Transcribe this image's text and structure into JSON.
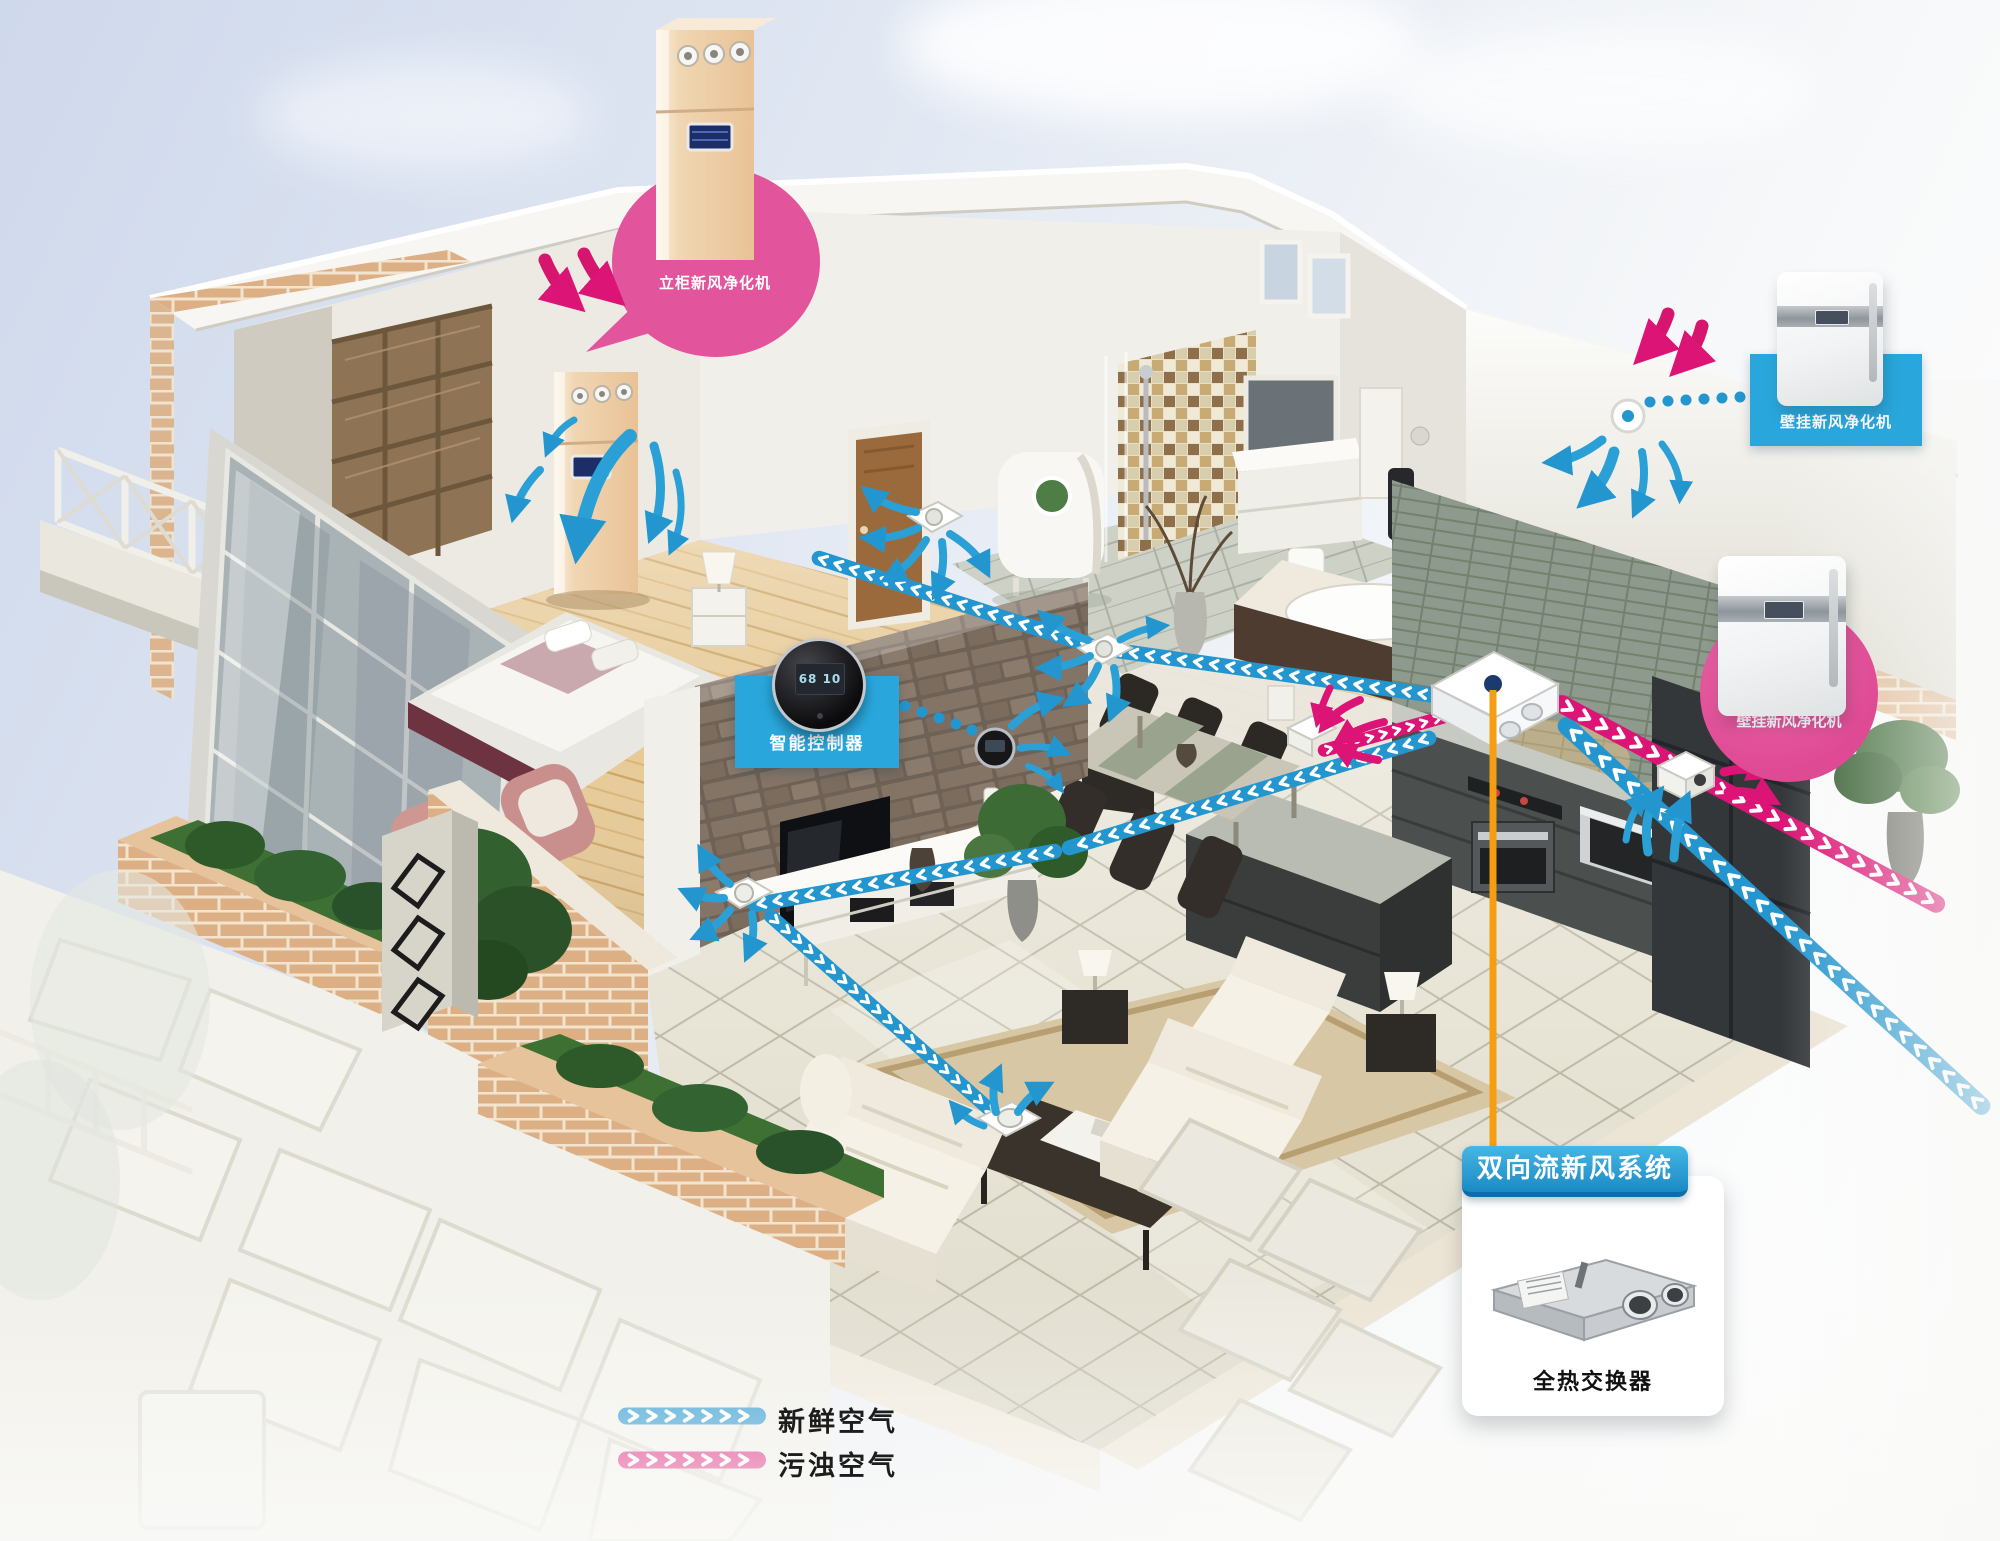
{
  "callouts": {
    "floor_unit": {
      "label": "立柜新风净化机"
    },
    "controller": {
      "label": "智能控制器"
    },
    "wall_unit_top": {
      "label": "壁挂新风净化机"
    },
    "wall_unit_kitchen": {
      "label": "壁挂新风净化机"
    },
    "system_card": {
      "title": "双向流新风系统",
      "caption": "全热交换器"
    }
  },
  "devices": {
    "controller_display": "68 10"
  },
  "legend": {
    "fresh_label": "新鲜空气",
    "dirty_label": "污浊空气"
  },
  "colors": {
    "label_blue": "#29a7dc",
    "label_pink": "#e2559c",
    "fresh_arrow_blue": "#2496cf",
    "dirty_arrow_pink": "#dc1475",
    "connector_orange": "#f59d13"
  }
}
